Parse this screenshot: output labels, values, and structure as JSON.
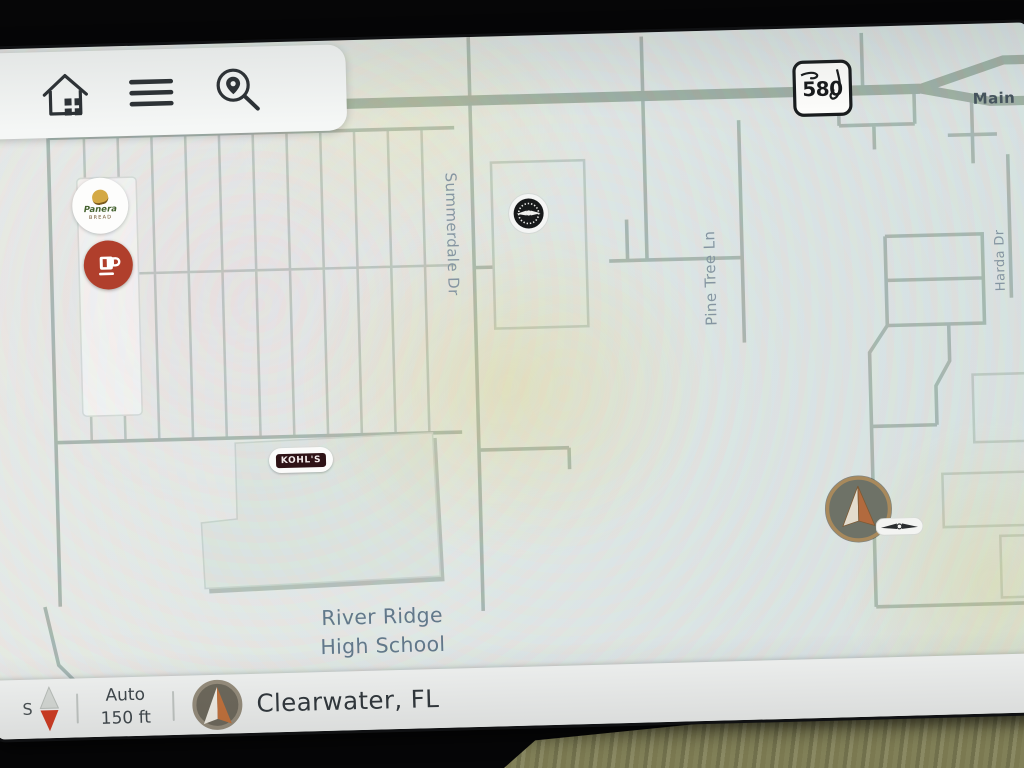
{
  "toolbar": {
    "icons": [
      "history-circle-icon",
      "home-icon",
      "menu-icon",
      "map-search-icon"
    ]
  },
  "map": {
    "route_shield": {
      "state": "florida-shield-icon",
      "number": "580"
    },
    "street_labels": {
      "main": "Main",
      "summerdale": "Summerdale Dr",
      "pine_tree": "Pine Tree Ln",
      "harda": "Harda Dr"
    },
    "poi": {
      "panera_line1": "Panera",
      "panera_line2": "BREAD",
      "kohls": "KOHL'S",
      "coffee_icon": "coffee-cup-icon",
      "badge_icon": "winged-badge-icon"
    },
    "place_label": {
      "line1": "River Ridge",
      "line2": "High School"
    },
    "vehicle_marker_icon": "vehicle-arrow-icon",
    "brand_badge_icon": "wings-logo-icon"
  },
  "status_bar": {
    "compass_letter": "S",
    "zoom_mode": "Auto",
    "zoom_scale": "150 ft",
    "location": "Clearwater, FL"
  },
  "colors": {
    "map_background": "#e2e7e5",
    "road": "#9cada2",
    "road_minor": "#a6b5ae",
    "compass_red": "#d23a20",
    "vehicle_ring_bronze": "#a8895c",
    "vehicle_arrow_orange": "#b26a3e",
    "coffee_red": "#b03f2c",
    "kohls_maroon": "#2e1216",
    "panel_white": "#f5f7f6"
  }
}
